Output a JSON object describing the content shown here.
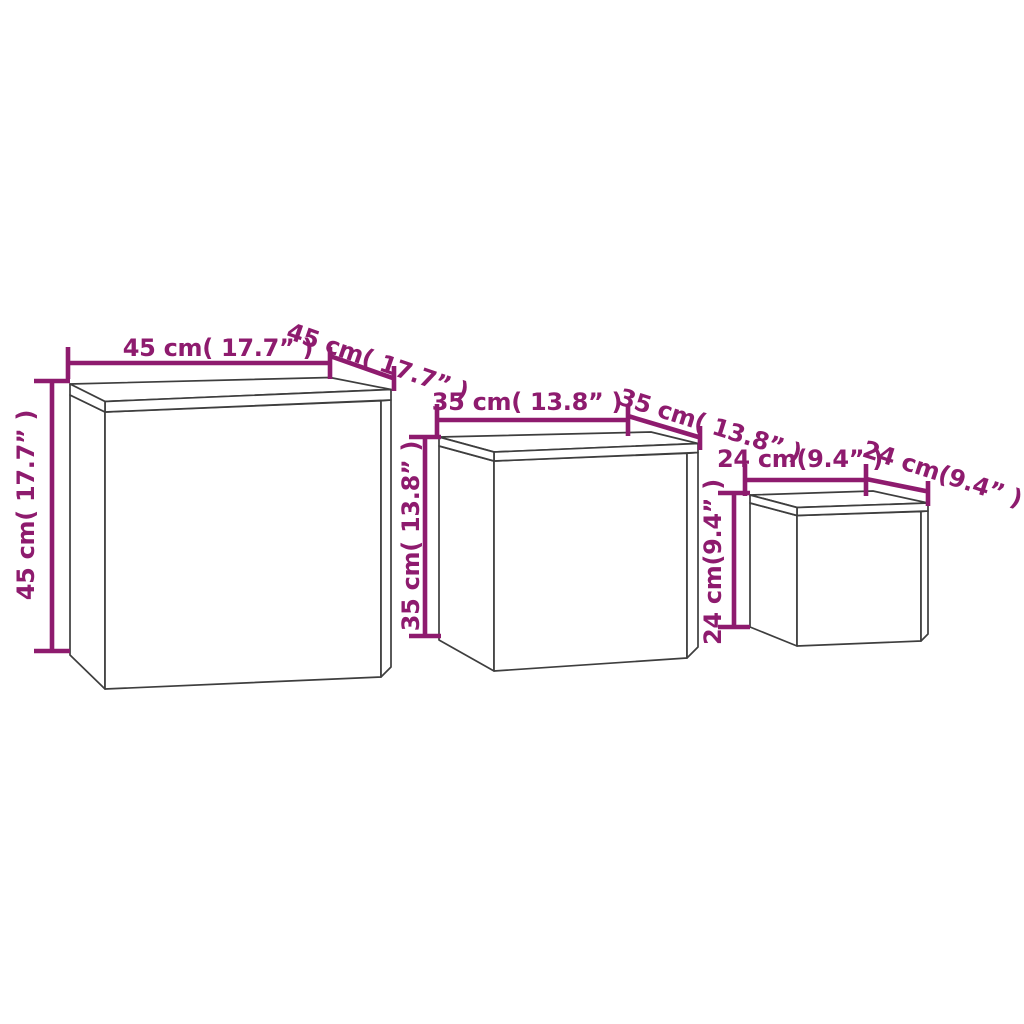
{
  "diagram": {
    "background_color": "#FFFFFF",
    "outline_color": "#3E3E3E",
    "dimension_color": "#8E1B6E",
    "tables": [
      {
        "size": "large",
        "width_cm": "45",
        "depth_cm": "45",
        "height_cm": "45",
        "width_in": "17.7",
        "depth_in": "17.7",
        "height_in": "17.7",
        "width_label": "45 cm( 17.7” )",
        "depth_label": "45 cm( 17.7” )",
        "height_label": "45 cm( 17.7” )"
      },
      {
        "size": "medium",
        "width_cm": "35",
        "depth_cm": "35",
        "height_cm": "35",
        "width_in": "13.8",
        "depth_in": "13.8",
        "height_in": "13.8",
        "width_label": "35 cm( 13.8” )",
        "depth_label": "35 cm( 13.8” )",
        "height_label": "35 cm( 13.8” )"
      },
      {
        "size": "small",
        "width_cm": "24",
        "depth_cm": "24",
        "height_cm": "24",
        "width_in": "9.4",
        "depth_in": "9.4",
        "height_in": "9.4",
        "width_label": "24 cm(9.4” )",
        "depth_label": "24 cm(9.4” )",
        "height_label": "24 cm(9.4” )"
      }
    ]
  }
}
